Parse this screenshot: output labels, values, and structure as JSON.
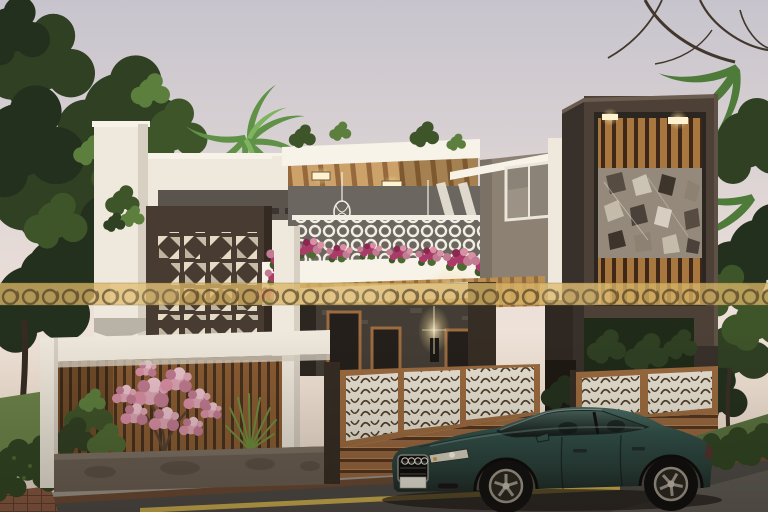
{
  "image": {
    "kind": "3d-architectural-exterior-rendering",
    "aria_label": "Photorealistic dusk rendering of a modern two-storey villa with wooden accents, perforated panels, flower-filled balcony, slatted compound fence and a dark teal coupe parked in front",
    "watermark_label": "translucent gold watermark band with repeating ring motifs",
    "labels": {
      "sky": "pale dusk sky",
      "trees": "background trees and palms",
      "house": "modern villa facade",
      "pergola": "rooftop wooden pergola with recessed lights and cage pendant lamps",
      "railing": "white ornate balcony railing",
      "flowers": "magenta balcony flowers",
      "tower": "dark feature tower with wooden slats and mirror mosaic panel",
      "fence": "wooden fence with white laser-cut panels",
      "blossom": "pink blossom tree",
      "car": "dark teal coupe parked on road",
      "road": "street with sidewalk, curb and yellow edge line"
    }
  },
  "palette": {
    "skyTop": "#c7c4cd",
    "skyMid": "#e6dbd7",
    "skyHorizon": "#f4e6d8",
    "treeDeep": "#23301d",
    "treeDark": "#2f4023",
    "treeMid": "#3e5429",
    "treeLight": "#5d7f3e",
    "palm": "#5f9147",
    "branch": "#42372c",
    "wallWhite": "#efe9dd",
    "wallBright": "#f8f3e8",
    "wallShade": "#d7cfc2",
    "wallTaupe": "#8d8173",
    "bandGray": "#5b544d",
    "panelBrown": "#483b31",
    "panelCut": "#e6dcc5",
    "woodLight": "#cda26a",
    "woodMid": "#9c6b3f",
    "woodDark": "#53351e",
    "towerDark": "#4c4037",
    "towerSide": "#38302a",
    "mirrorBg": "#95897b",
    "stoneDark": "#433d35",
    "planter": "#6b6054",
    "fencePanel": "#eae4d6",
    "fenceCut": "#4f3e2a",
    "railWhite": "#f3eee3",
    "railBg": "#6b665f",
    "flowerMagenta": "#ac3a68",
    "flowerPink": "#d98fa4",
    "blossom": "#dda5b4",
    "blossomDeep": "#c17b92",
    "grass": "#6b8449",
    "hedge": "#2f4522",
    "sidewalk": "#a19b8f",
    "road": "#4d4a46",
    "roadLight": "#6f6b64",
    "curbBrick": "#6b4a33",
    "brick": "#8a5a41",
    "lineYellow": "#d9ba52",
    "carBody": "#30504a",
    "carGlassDark": "#101816",
    "wheel": "#a29b8e",
    "glow": "#fff3cf",
    "wmGold": "#d8b566",
    "wmRing": "#3e301b"
  }
}
